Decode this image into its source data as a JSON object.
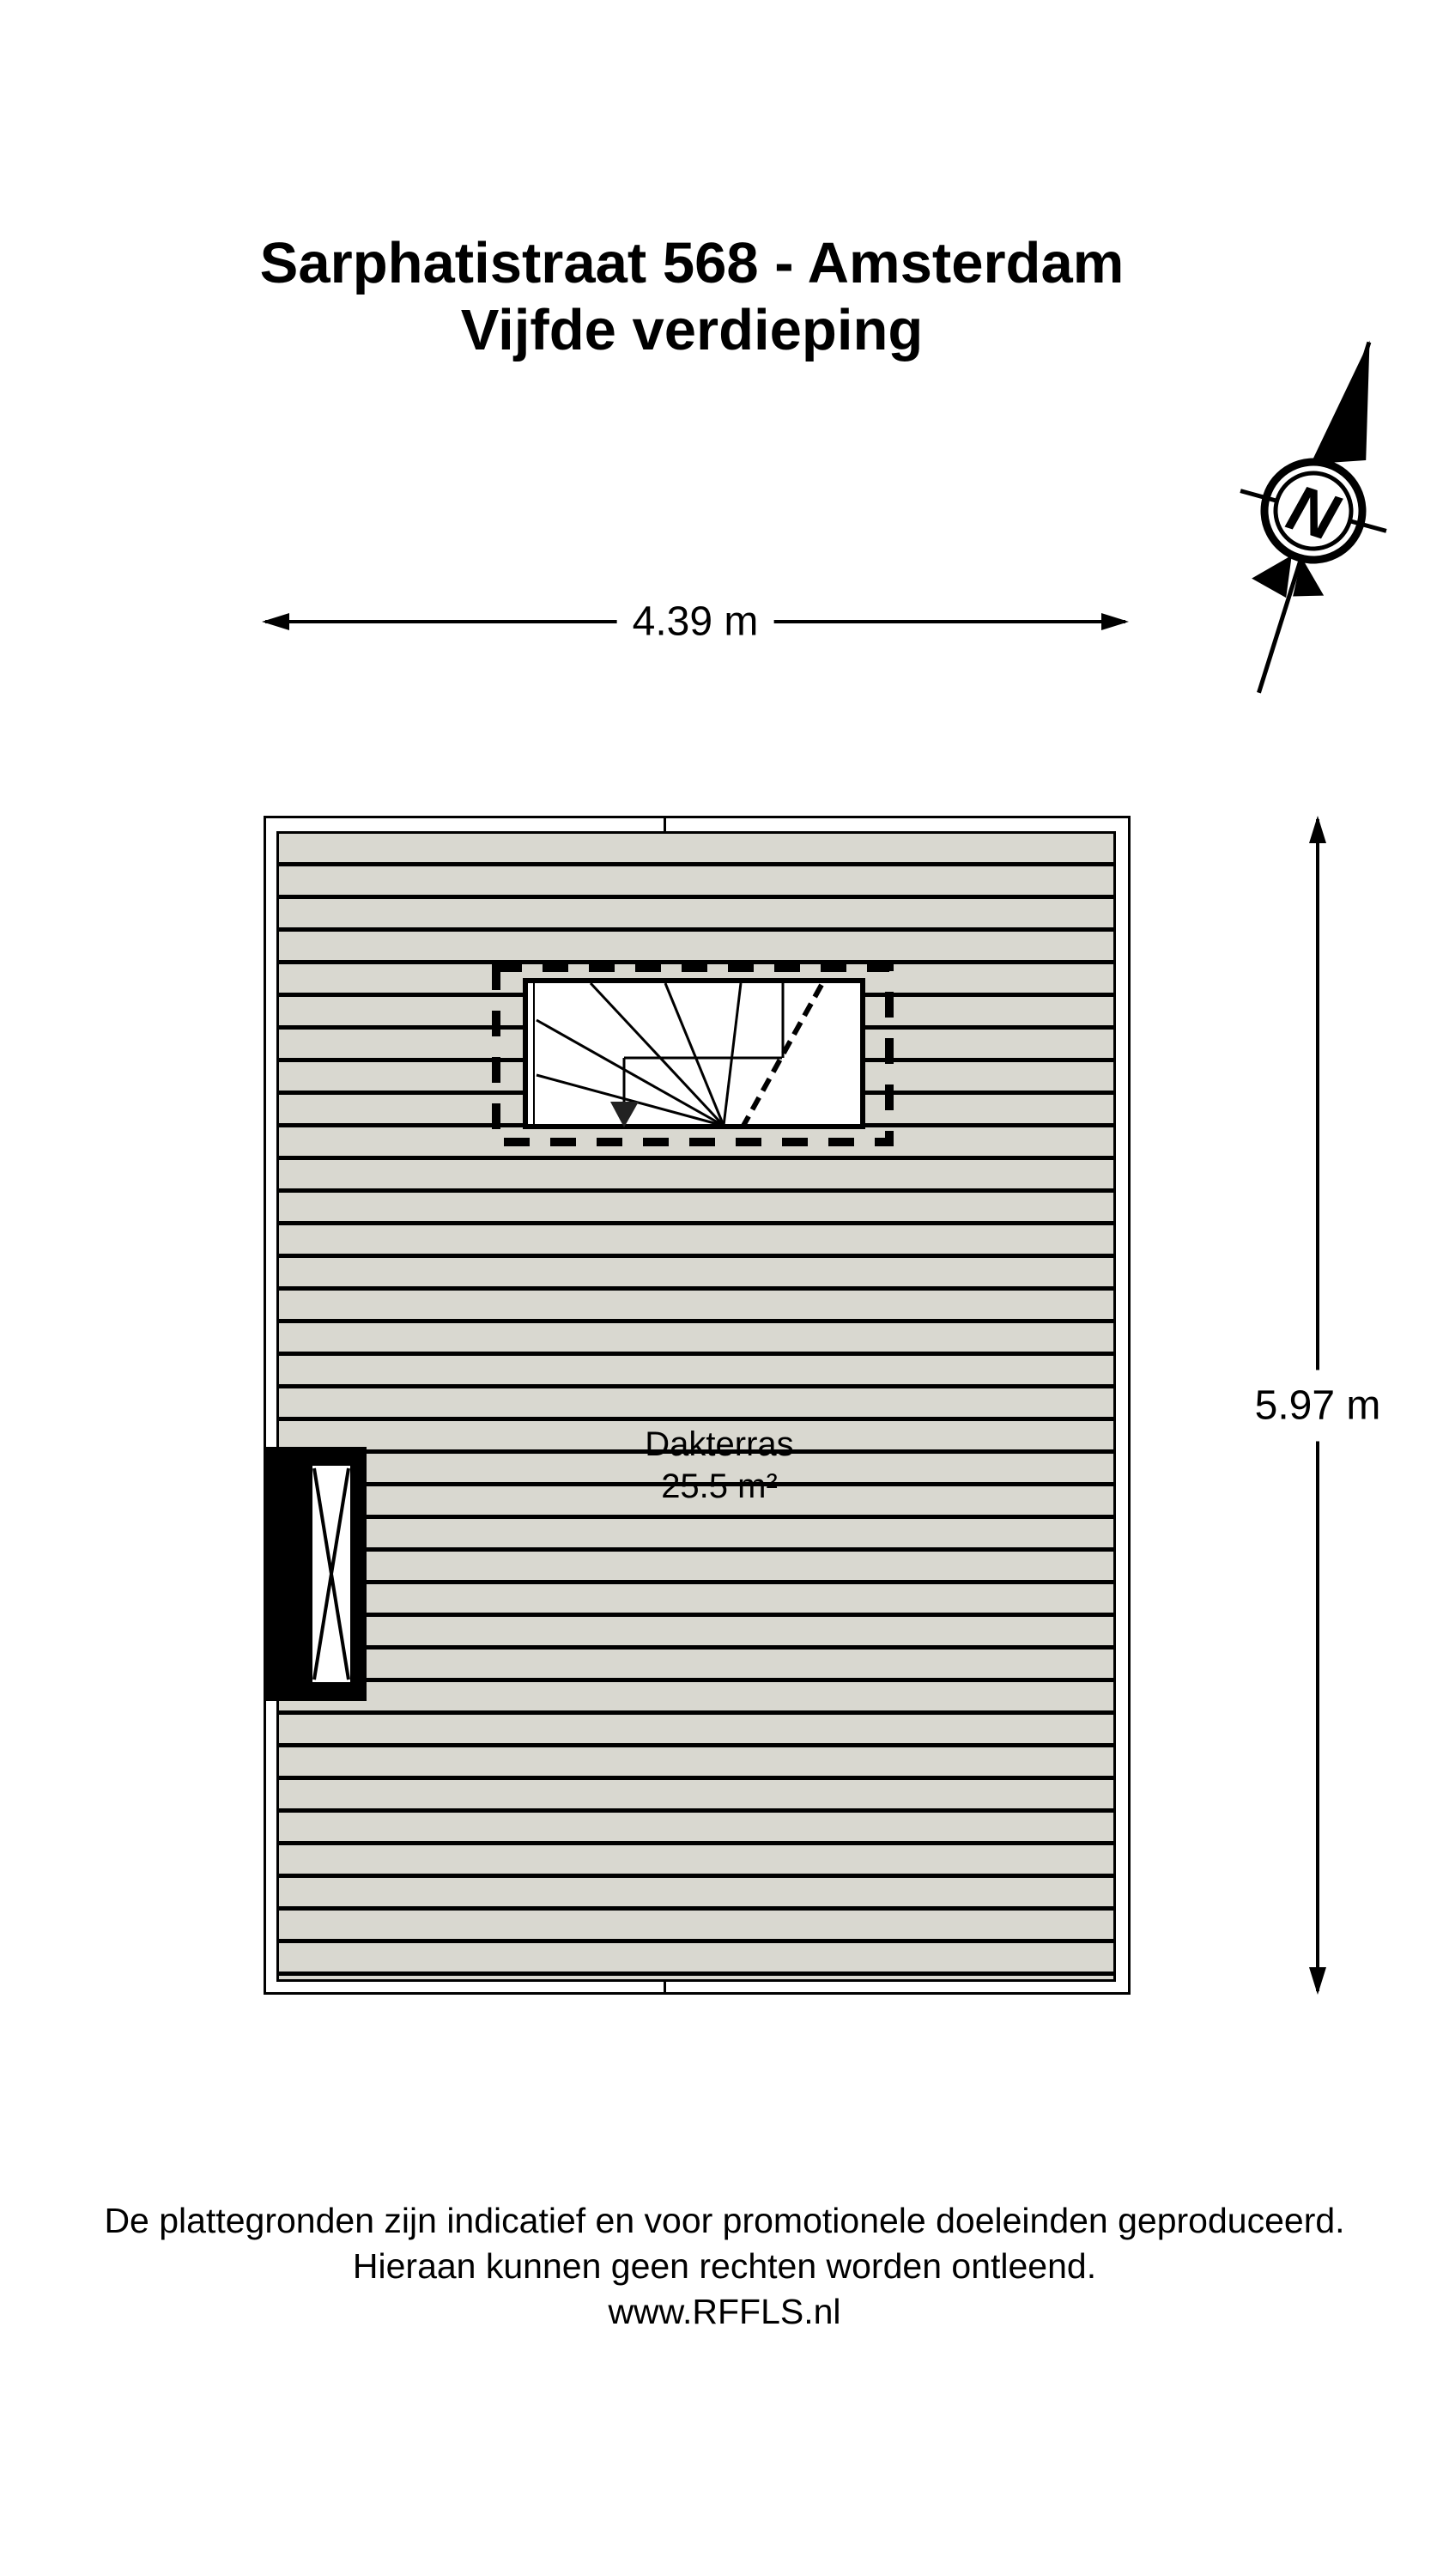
{
  "header": {
    "title_line1": "Sarphatistraat 568 - Amsterdam",
    "title_line2": "Vijfde verdieping"
  },
  "compass": {
    "label": "N"
  },
  "dimensions": {
    "width_label": "4.39 m",
    "height_label": "5.97 m"
  },
  "room": {
    "name": "Dakterras",
    "area": "25.5 m²"
  },
  "footer": {
    "line1": "De plattegronden zijn indicatief en voor promotionele doeleinden geproduceerd.",
    "line2": "Hieraan kunnen geen rechten worden ontleend.",
    "line3": "www.RFFLS.nl"
  },
  "colors": {
    "line": "#000000",
    "deck_board": "#d9d8d0",
    "background": "#ffffff"
  }
}
